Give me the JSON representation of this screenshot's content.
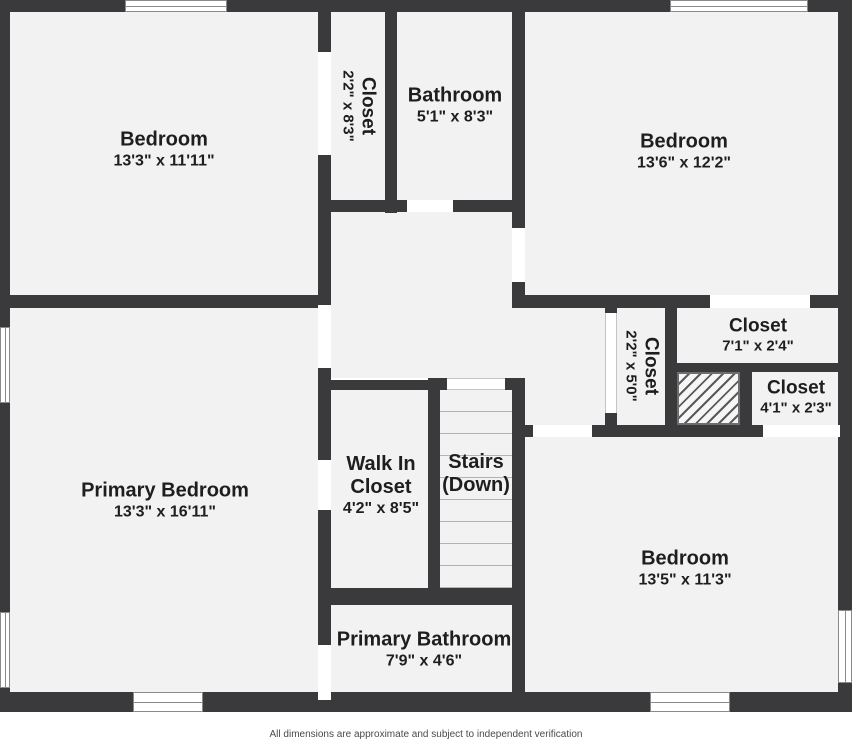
{
  "plan": {
    "title": "Second floor plan",
    "rooms": {
      "bedroom_tl": {
        "name": "Bedroom",
        "dims": "13'3\" x 11'11\""
      },
      "closet_top": {
        "name": "Closet",
        "dims": "2'2\" x 8'3\""
      },
      "bathroom": {
        "name": "Bathroom",
        "dims": "5'1\" x 8'3\""
      },
      "bedroom_tr": {
        "name": "Bedroom",
        "dims": "13'6\" x 12'2\""
      },
      "closet_71": {
        "name": "Closet",
        "dims": "7'1\" x 2'4\""
      },
      "closet_50": {
        "name": "Closet",
        "dims": "2'2\" x 5'0\""
      },
      "closet_41": {
        "name": "Closet",
        "dims": "4'1\" x 2'3\""
      },
      "primary_bedroom": {
        "name": "Primary Bedroom",
        "dims": "13'3\" x 16'11\""
      },
      "walk_in_closet": {
        "name_line1": "Walk In",
        "name_line2": "Closet",
        "dims": "4'2\" x 8'5\""
      },
      "stairs": {
        "name": "Stairs",
        "sub": "(Down)"
      },
      "bedroom_br": {
        "name": "Bedroom",
        "dims": "13'5\" x 11'3\""
      },
      "primary_bathroom": {
        "name": "Primary Bathroom",
        "dims": "7'9\" x 4'6\""
      }
    },
    "colors": {
      "wall": "#3a3a3c",
      "room_fill": "#f2f2f2",
      "opening": "#ffffff",
      "label_text": "#1e1e1e",
      "footer_text": "#4a4a4a"
    },
    "footer": {
      "disclaimer": "All dimensions are approximate and subject to independent verification"
    }
  }
}
